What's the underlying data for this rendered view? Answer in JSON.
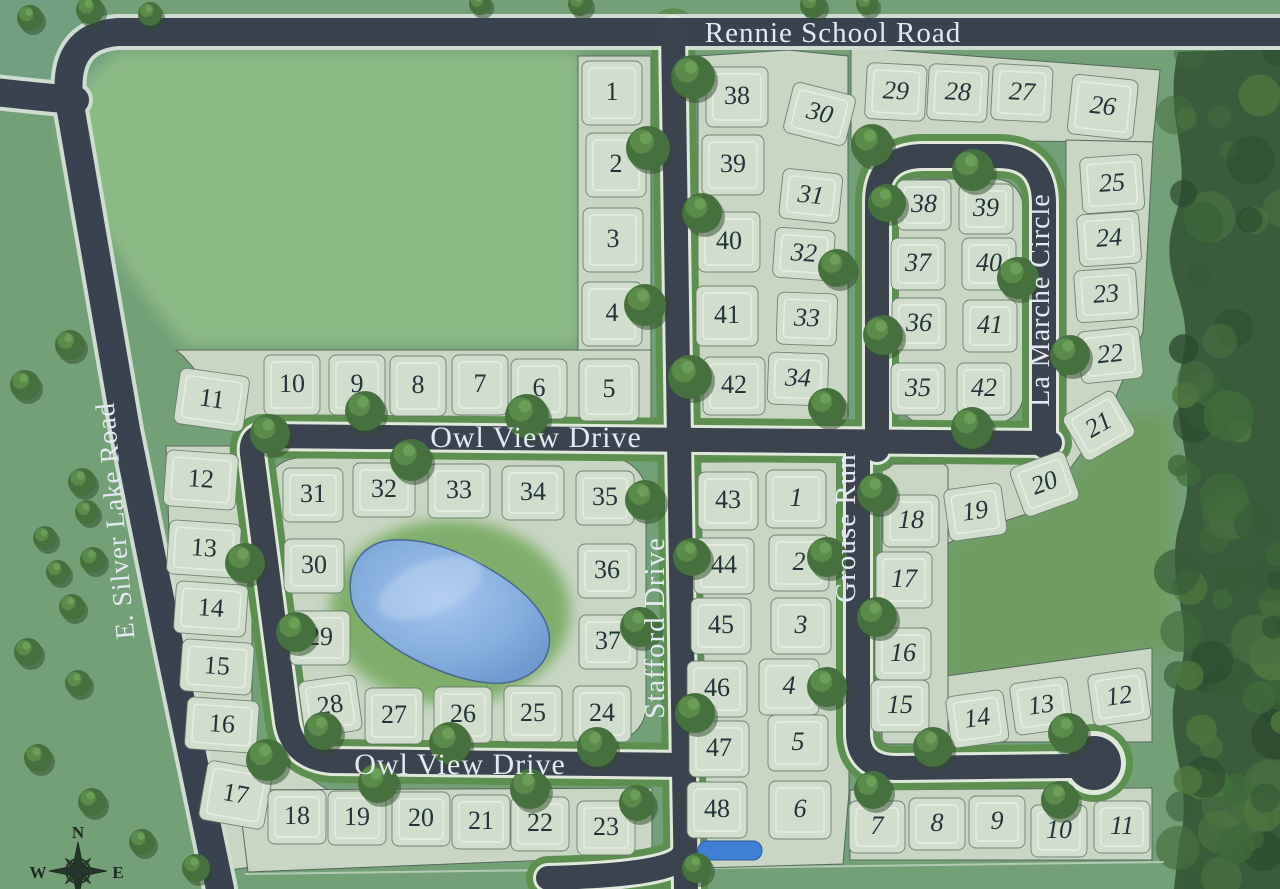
{
  "map": {
    "description": "Residential subdivision site plan",
    "road_names": {
      "rennie": "Rennie School Road",
      "silver_lake": "E. Silver Lake Road",
      "owl_view": "Owl View Drive",
      "stafford": "Stafford Drive",
      "grouse": "Grouse Run",
      "la_marche": "La Marche Circle"
    },
    "road_labels": [
      {
        "text": "Rennie School Road",
        "x": 833,
        "y": 42,
        "rot": 0,
        "size": 29
      },
      {
        "text": "E. Silver Lake Road",
        "x": 124,
        "y": 520,
        "rot": -95,
        "size": 27
      },
      {
        "text": "Owl View Drive",
        "x": 536,
        "y": 447,
        "rot": 0,
        "size": 30
      },
      {
        "text": "Owl View Drive",
        "x": 460,
        "y": 774,
        "rot": 0,
        "size": 30
      },
      {
        "text": "Stafford Drive",
        "x": 664,
        "y": 628,
        "rot": -90,
        "size": 29
      },
      {
        "text": "Grouse Run",
        "x": 855,
        "y": 528,
        "rot": -90,
        "size": 29
      },
      {
        "text": "La Marche Circle",
        "x": 1049,
        "y": 300,
        "rot": -90,
        "size": 28
      }
    ],
    "compass": {
      "cx": 78,
      "cy": 871,
      "letters": [
        {
          "t": "N",
          "x": 78,
          "y": 838
        },
        {
          "t": "W",
          "x": 38,
          "y": 878
        },
        {
          "t": "E",
          "x": 118,
          "y": 878
        }
      ]
    },
    "colors": {
      "grass": "#74a077",
      "field": "#8cba85",
      "open_green": "#6f9c61",
      "lot_fill": "#cbd8c6",
      "tile_fill": "#d2decd",
      "lot_stroke": "#5f7265",
      "envelope": "#edf3e9",
      "asphalt": "#3a434e",
      "verge": "#5d9050",
      "pale_edge": "#dfe8da",
      "pond": "#85aede",
      "pond_edge": "#49688f",
      "small_pond": "#3f7fd4",
      "tree": "#47703f",
      "forest": "#3a5c3c",
      "number": "#22333a",
      "label": "#e4e9f2"
    },
    "geometry": {
      "field": "M118,52 L580,52 L580,346 L186,346 Q95,240 64,142 Q58,95 118,52 Z",
      "open_green": [
        [
          946,
          548
        ],
        [
          1048,
          506
        ],
        [
          1124,
          416
        ],
        [
          1170,
          416
        ],
        [
          1170,
          652
        ],
        [
          1150,
          650
        ],
        [
          946,
          682
        ]
      ],
      "forest": "M1280,48 L1178,52 C1162,120 1196,158 1174,220 C1156,282 1197,300 1182,362 C1166,424 1202,462 1180,522 C1162,582 1199,622 1177,682 C1161,742 1196,782 1179,842 L1174,889 L1280,889 Z",
      "roads_major": [
        "M1285,32 L118,32 Q60,36 70,105 L126,430 L170,648 L220,889",
        "M75,100 Q40,97 -5,92"
      ],
      "roads_minor": [
        "M1050,443 L262,436 Q250,438 252,454 L287,722 Q293,758 332,761 L688,765",
        "M673,30 L679,440 L684,770 L686,889",
        "M683,855 Q675,875 548,878",
        "M858,446 L858,733 Q858,768 897,768 L1070,766",
        "M877,450 L877,202 Q877,156 924,156 L998,156 Q1044,156 1044,204 L1044,446"
      ],
      "culdesac": {
        "cx": 1094,
        "cy": 763,
        "r": 27
      },
      "blocks": [
        [
          [
            578,
            56
          ],
          [
            651,
            56
          ],
          [
            651,
            424
          ],
          [
            578,
            424
          ]
        ],
        [
          [
            176,
            350
          ],
          [
            651,
            350
          ],
          [
            651,
            424
          ],
          [
            246,
            428
          ],
          [
            183,
            356
          ]
        ],
        [
          [
            166,
            446
          ],
          [
            252,
            446
          ],
          [
            252,
            740
          ],
          [
            340,
            798
          ],
          [
            302,
            860
          ],
          [
            215,
            872
          ],
          [
            170,
            560
          ]
        ],
        [
          [
            238,
            790
          ],
          [
            652,
            788
          ],
          [
            652,
            856
          ],
          [
            248,
            872
          ]
        ],
        [
          [
            698,
            56
          ],
          [
            788,
            50
          ],
          [
            848,
            56
          ],
          [
            848,
            428
          ],
          [
            698,
            428
          ]
        ],
        [
          [
            851,
            47
          ],
          [
            1160,
            70
          ],
          [
            1153,
            142
          ],
          [
            851,
            140
          ]
        ],
        [
          [
            1066,
            140
          ],
          [
            1153,
            142
          ],
          [
            1143,
            332
          ],
          [
            1109,
            413
          ],
          [
            1066,
            442
          ]
        ],
        [
          [
            944,
            464
          ],
          [
            1050,
            440
          ],
          [
            1110,
            414
          ],
          [
            1040,
            510
          ],
          [
            966,
            533
          ],
          [
            944,
            546
          ]
        ],
        [
          [
            699,
            462
          ],
          [
            849,
            462
          ],
          [
            849,
            792
          ],
          [
            843,
            864
          ],
          [
            699,
            868
          ]
        ],
        [
          [
            946,
            676
          ],
          [
            1152,
            648
          ],
          [
            1152,
            742
          ],
          [
            946,
            742
          ]
        ],
        [
          [
            850,
            790
          ],
          [
            1152,
            788
          ],
          [
            1152,
            860
          ],
          [
            850,
            860
          ]
        ]
      ],
      "block_rects": [
        {
          "x": 264,
          "y": 458,
          "w": 382,
          "h": 284,
          "rx": 36
        },
        {
          "x": 897,
          "y": 179,
          "w": 126,
          "h": 244,
          "rx": 28
        },
        {
          "x": 882,
          "y": 464,
          "w": 66,
          "h": 280,
          "rx": 6
        }
      ],
      "pond_halo": {
        "cx": 450,
        "cy": 612,
        "rx": 135,
        "ry": 105
      },
      "pond": "M352,602 C344,566 364,541 394,540 C430,538 466,553 501,576 C531,596 553,621 549,646 C546,669 520,686 489,683 C454,680 409,660 384,640 C364,624 356,616 352,602 Z",
      "small_pond": {
        "x": 698,
        "y": 841,
        "w": 64,
        "h": 19,
        "rx": 9
      },
      "boundary_bottom": [
        [
          245,
          874
        ],
        [
          1164,
          862
        ]
      ]
    },
    "lots_west": [
      [
        1,
        612,
        91,
        60,
        64,
        0
      ],
      [
        2,
        616,
        163,
        60,
        64,
        0
      ],
      [
        3,
        613,
        238,
        60,
        64,
        0
      ],
      [
        4,
        612,
        312,
        60,
        64,
        0
      ],
      [
        5,
        609,
        388,
        60,
        62,
        0
      ],
      [
        6,
        539,
        387,
        56,
        60,
        0
      ],
      [
        7,
        480,
        383,
        56,
        60,
        0
      ],
      [
        8,
        418,
        384,
        56,
        60,
        0
      ],
      [
        9,
        357,
        383,
        56,
        60,
        0
      ],
      [
        10,
        292,
        383,
        56,
        60,
        0
      ],
      [
        11,
        212,
        398,
        70,
        56,
        8
      ],
      [
        12,
        201,
        478,
        72,
        56,
        4
      ],
      [
        13,
        204,
        547,
        72,
        54,
        4
      ],
      [
        14,
        211,
        607,
        72,
        52,
        4
      ],
      [
        15,
        217,
        665,
        72,
        52,
        4
      ],
      [
        16,
        222,
        723,
        72,
        52,
        4
      ],
      [
        17,
        236,
        793,
        66,
        60,
        10
      ],
      [
        18,
        297,
        815,
        58,
        54,
        0
      ],
      [
        19,
        357,
        816,
        58,
        54,
        0
      ],
      [
        20,
        421,
        817,
        58,
        54,
        0
      ],
      [
        21,
        481,
        820,
        58,
        54,
        0
      ],
      [
        22,
        540,
        822,
        58,
        54,
        0
      ],
      [
        23,
        606,
        826,
        58,
        54,
        0
      ],
      [
        24,
        602,
        712,
        58,
        56,
        0
      ],
      [
        25,
        533,
        712,
        58,
        56,
        0
      ],
      [
        26,
        463,
        713,
        58,
        56,
        0
      ],
      [
        27,
        394,
        714,
        58,
        56,
        0
      ],
      [
        28,
        330,
        704,
        58,
        56,
        -8
      ],
      [
        29,
        320,
        636,
        60,
        54,
        0
      ],
      [
        30,
        314,
        564,
        60,
        54,
        0
      ],
      [
        31,
        313,
        493,
        60,
        54,
        0
      ],
      [
        32,
        384,
        488,
        62,
        54,
        0
      ],
      [
        33,
        459,
        489,
        62,
        54,
        0
      ],
      [
        34,
        533,
        491,
        62,
        54,
        0
      ],
      [
        35,
        605,
        496,
        58,
        54,
        0
      ],
      [
        36,
        607,
        569,
        58,
        54,
        0
      ],
      [
        37,
        608,
        640,
        58,
        54,
        0
      ],
      [
        38,
        737,
        95,
        62,
        60,
        0
      ],
      [
        39,
        733,
        163,
        62,
        60,
        0
      ],
      [
        40,
        729,
        240,
        62,
        60,
        0
      ],
      [
        41,
        727,
        314,
        62,
        60,
        0
      ],
      [
        42,
        734,
        384,
        62,
        58,
        0
      ],
      [
        43,
        728,
        499,
        60,
        58,
        0
      ],
      [
        44,
        724,
        564,
        60,
        56,
        0
      ],
      [
        45,
        721,
        624,
        60,
        56,
        0
      ],
      [
        46,
        717,
        687,
        60,
        56,
        0
      ],
      [
        47,
        719,
        747,
        60,
        56,
        0
      ],
      [
        48,
        717,
        808,
        60,
        56,
        0
      ]
    ],
    "lots_east": [
      [
        1,
        796,
        497,
        60,
        58,
        0
      ],
      [
        2,
        799,
        561,
        60,
        56,
        0
      ],
      [
        3,
        801,
        624,
        60,
        56,
        0
      ],
      [
        4,
        789,
        685,
        60,
        56,
        0
      ],
      [
        5,
        798,
        741,
        60,
        56,
        0
      ],
      [
        6,
        800,
        808,
        62,
        58,
        0
      ],
      [
        7,
        877,
        825,
        56,
        52,
        0
      ],
      [
        8,
        937,
        822,
        56,
        52,
        0
      ],
      [
        9,
        997,
        820,
        56,
        52,
        0
      ],
      [
        10,
        1059,
        829,
        56,
        52,
        0
      ],
      [
        11,
        1122,
        825,
        56,
        52,
        0
      ],
      [
        12,
        1119,
        695,
        58,
        52,
        -8
      ],
      [
        13,
        1041,
        704,
        58,
        52,
        -8
      ],
      [
        14,
        977,
        717,
        58,
        52,
        -8
      ],
      [
        15,
        900,
        704,
        58,
        52,
        0
      ],
      [
        16,
        903,
        652,
        56,
        52,
        0
      ],
      [
        17,
        904,
        578,
        56,
        56,
        0
      ],
      [
        18,
        911,
        519,
        56,
        52,
        0
      ],
      [
        19,
        975,
        510,
        58,
        52,
        -8
      ],
      [
        20,
        1044,
        482,
        58,
        52,
        -20
      ],
      [
        21,
        1098,
        424,
        58,
        52,
        -30
      ],
      [
        22,
        1110,
        353,
        62,
        52,
        -6
      ],
      [
        23,
        1106,
        293,
        62,
        52,
        -4
      ],
      [
        24,
        1109,
        237,
        62,
        52,
        -4
      ],
      [
        25,
        1112,
        182,
        62,
        56,
        -4
      ],
      [
        26,
        1103,
        105,
        66,
        60,
        6
      ],
      [
        27,
        1022,
        91,
        60,
        56,
        3
      ],
      [
        28,
        958,
        91,
        60,
        56,
        3
      ],
      [
        29,
        896,
        90,
        60,
        56,
        3
      ],
      [
        30,
        820,
        112,
        64,
        52,
        14
      ],
      [
        31,
        811,
        194,
        60,
        50,
        6
      ],
      [
        32,
        804,
        252,
        60,
        50,
        4
      ],
      [
        33,
        807,
        317,
        60,
        52,
        2
      ],
      [
        34,
        798,
        377,
        60,
        52,
        2
      ],
      [
        35,
        918,
        387,
        54,
        52,
        0
      ],
      [
        36,
        919,
        322,
        54,
        52,
        0
      ],
      [
        37,
        918,
        262,
        54,
        52,
        0
      ],
      [
        38,
        924,
        203,
        54,
        50,
        0
      ],
      [
        39,
        986,
        207,
        54,
        50,
        0
      ],
      [
        40,
        989,
        262,
        54,
        52,
        0
      ],
      [
        41,
        990,
        324,
        54,
        52,
        0
      ],
      [
        42,
        984,
        387,
        54,
        52,
        0
      ]
    ],
    "trees": [
      [
        693,
        77,
        22
      ],
      [
        648,
        148,
        22
      ],
      [
        702,
        213,
        20
      ],
      [
        645,
        305,
        21
      ],
      [
        690,
        377,
        22
      ],
      [
        270,
        434,
        20
      ],
      [
        365,
        411,
        20
      ],
      [
        411,
        460,
        21
      ],
      [
        527,
        416,
        22
      ],
      [
        245,
        563,
        20
      ],
      [
        296,
        632,
        20
      ],
      [
        267,
        760,
        21
      ],
      [
        323,
        731,
        19
      ],
      [
        378,
        783,
        20
      ],
      [
        450,
        743,
        21
      ],
      [
        530,
        789,
        20
      ],
      [
        597,
        747,
        20
      ],
      [
        637,
        803,
        18
      ],
      [
        645,
        500,
        20
      ],
      [
        640,
        627,
        20
      ],
      [
        692,
        557,
        19
      ],
      [
        695,
        713,
        20
      ],
      [
        827,
        557,
        20
      ],
      [
        827,
        687,
        20
      ],
      [
        877,
        493,
        20
      ],
      [
        877,
        617,
        20
      ],
      [
        933,
        747,
        20
      ],
      [
        873,
        790,
        19
      ],
      [
        1068,
        733,
        20
      ],
      [
        1060,
        800,
        19
      ],
      [
        872,
        145,
        21
      ],
      [
        973,
        170,
        21
      ],
      [
        887,
        203,
        19
      ],
      [
        1018,
        278,
        21
      ],
      [
        883,
        335,
        20
      ],
      [
        972,
        428,
        21
      ],
      [
        1070,
        355,
        20
      ],
      [
        837,
        268,
        19
      ],
      [
        827,
        407,
        19
      ],
      [
        813,
        5,
        13
      ],
      [
        867,
        4,
        11
      ],
      [
        580,
        4,
        12
      ],
      [
        480,
        4,
        11
      ],
      [
        90,
        10,
        14
      ],
      [
        30,
        18,
        13
      ],
      [
        150,
        14,
        12
      ],
      [
        25,
        385,
        15
      ],
      [
        82,
        482,
        14
      ],
      [
        87,
        512,
        12
      ],
      [
        93,
        560,
        13
      ],
      [
        58,
        572,
        12
      ],
      [
        45,
        538,
        12
      ],
      [
        72,
        607,
        13
      ],
      [
        28,
        652,
        14
      ],
      [
        78,
        683,
        13
      ],
      [
        38,
        758,
        14
      ],
      [
        92,
        802,
        14
      ],
      [
        142,
        842,
        13
      ],
      [
        196,
        868,
        14
      ],
      [
        697,
        868,
        15
      ],
      [
        70,
        345,
        15
      ]
    ]
  }
}
